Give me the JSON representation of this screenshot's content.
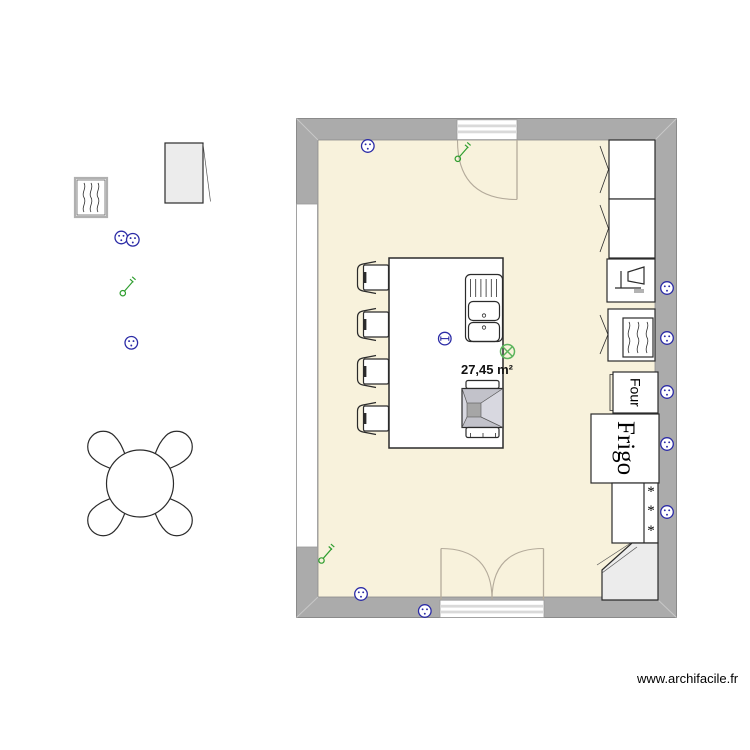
{
  "plan": {
    "area_label": "27,45 m²",
    "watermark": "www.archifacile.fr"
  },
  "appliances": {
    "oven_label": "Four",
    "fridge_label": "Frigo",
    "freezer_stars": [
      "*",
      "*",
      "*"
    ]
  },
  "icons": {
    "outlet": "power-outlet",
    "switch": "light-switch",
    "light": "ceiling-light",
    "dishwasher": "dishwasher-glass",
    "heater": "radiator-waves"
  },
  "colors": {
    "wall": "#ababab",
    "floor": "#f8f2dc",
    "outline": "#8a8a8a",
    "furniture-stroke": "#2b2b2b",
    "electric-blue": "#2b2ba6",
    "switch-green": "#2f9e2f",
    "light-green": "#5cb55c",
    "door-arc": "#b4ab9b",
    "corner-unit-fill": "#ececec",
    "hood-light": "#d8d8e0",
    "hood-mid": "#c2c2ca",
    "hood-dark": "#a6a6a6"
  }
}
